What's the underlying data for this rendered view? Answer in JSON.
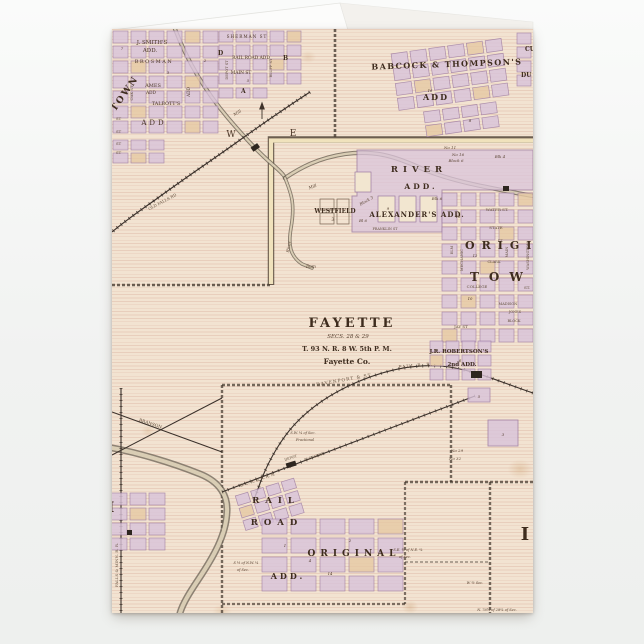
{
  "theme": {
    "page_background": "#f1f2f1",
    "card_paper": "#f2e3d1",
    "ruling_line": "#c17968",
    "block_fill": "#d9c3da",
    "block_tan": "#e6c9a4",
    "block_edge": "#9b79a2",
    "ink": "#463527",
    "road_cream": "#f0e2bc",
    "river": "#8d8270",
    "fold_white": "#fbfbfa"
  },
  "map": {
    "labels": {
      "st": "ST",
      "smiths_add_1": "J. SMITH'S",
      "smiths_add_2": "ADD.",
      "brosman": "BROSMAN",
      "town_vertical": "TOWN",
      "oak_st": "OAK ST",
      "ames_1": "AMES",
      "ames_2": "ADD",
      "add_vertical": "ADD",
      "talbotts": "TALBOTT'S",
      "talbotts_add": "ADD",
      "sherman_st": "SHERMAN ST",
      "railroad_add": "RAIL ROAD ADD",
      "main_st": "MAIN ST",
      "depot_st": "DEPOT ST",
      "bluff_st": "BLUFF ST",
      "letter_d": "D",
      "letter_b": "B",
      "letter_a": "A",
      "babcock_1": "BABCOCK & THOMPSON'S",
      "babcock_2": "ADD",
      "cu": "CU",
      "du": "DU",
      "no_11": "No 11",
      "no_16": "No 16",
      "block_6": "Block 6",
      "blk_4": "Blk 4",
      "blk_6": "Blk 6",
      "bl_6": "Bl 6",
      "block_3": "Block 3",
      "river_add_1": "RIVER",
      "river_add_2": "ADD.",
      "westfield": "WESTFIELD",
      "westfield_3": "3",
      "alexanders_add": "ALEXANDER'S ADD.",
      "franklin_st": "FRANKLIN ST",
      "river_word": "River",
      "dam": "Dam",
      "mill": "Mill",
      "letter_w": "W",
      "letter_e": "E",
      "water_st": "WATER ST.",
      "state_st": "STATE",
      "clark_st": "CLARK",
      "main_vert": "MAIN",
      "mechanic_st": "MECHANIC",
      "elm_st": "ELM",
      "washington_st": "WASHINGTON",
      "original_right": "ORIGINAL",
      "town_right": "TOWN",
      "college_st_1": "COLLEGE",
      "college_st_2": "ST.",
      "madison": "MADISON",
      "jones": "JONES",
      "block_word": "BLOCK",
      "jay_st": "JAY ST",
      "fayette_title": "FAYETTE",
      "fayette_secs": "SECS. 28 & 29",
      "fayette_twp": "T. 93 N. R. 8 W. 5th P. M.",
      "fayette_co": "Fayette Co.",
      "davenport_1": "DAVENPORT & ST.",
      "davenport_2": "PAUL R. R.",
      "robertsons_1": "J.R. ROBERTSON'S",
      "robertsons_2": "2nd ADD.",
      "no_29": "No 29",
      "no_32": "No 32",
      "branson": "BRANSON",
      "bcrn": "B. C. R. & N. R. R.",
      "elevator": "ELEVATOR",
      "depot": "DEPOT",
      "rail": "RAIL",
      "road": "ROAD",
      "original_bottom": "ORIGINAL",
      "add_bottom": "ADD.",
      "frac_1": "S.W. ¼ of Sec.",
      "frac_2": "Fractional",
      "note_sw_1": "S ½ of N.W. ¼",
      "note_sw_2": "of Sec.",
      "note_se_1": "S.E. ¼ of N.E. ¼",
      "note_se_2": "of Sec.",
      "w_half": "W ½ Sec.",
      "n76": "N. 76¾ of 28¼ of Sec.",
      "falls_minn_rr": "FALLS & MINN. R. R.",
      "old_falls_rd": "OLD FALLS RD",
      "letter_i_right": "I",
      "letter_i_left": "I"
    },
    "block_numbers": [
      "7",
      "3",
      "2",
      "5",
      "16",
      "8",
      "15",
      "12",
      "17",
      "4",
      "2",
      "1",
      "6",
      "5",
      "3",
      "9",
      "10",
      "14"
    ]
  }
}
